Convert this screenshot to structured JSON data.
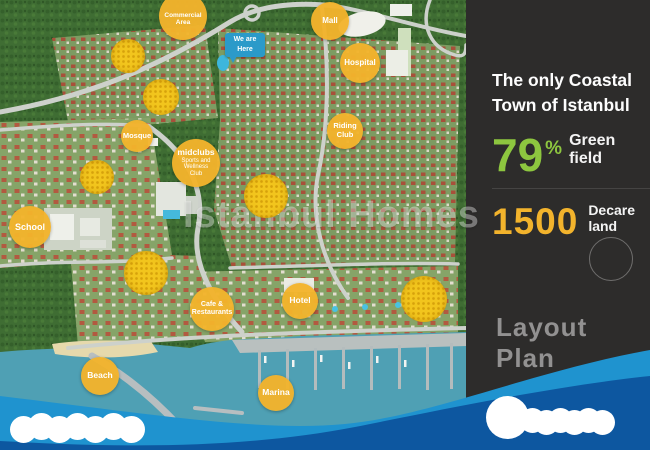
{
  "map": {
    "we_are_here": {
      "line1": "We are",
      "line2": "Here"
    },
    "pois": {
      "commercial_area": "Commercial Area",
      "mall": "Mall",
      "hospital": "Hospital",
      "mosque": "Mosque",
      "riding_club": "Riding Club",
      "midclubs_title": "midclubs",
      "midclubs_subtitle": "Sports and Wellness Club",
      "school": "School",
      "cafe_restaurants": "Cafe & Restaurants",
      "hotel": "Hotel",
      "beach": "Beach",
      "marina": "Marina"
    },
    "watermark": "Istanbul Homes"
  },
  "panel": {
    "heading_line1": "The only Coastal",
    "heading_line2": "Town of Istanbul",
    "green_stat": {
      "value": "79",
      "unit": "%",
      "label": "Green field",
      "color": "#8dc63f"
    },
    "land_stat": {
      "value": "1500",
      "label": "Decare land",
      "color": "#f2b32c"
    },
    "footer_label": "Layout Plan"
  },
  "colors": {
    "poi_yellow": "#f2b32c",
    "scribble_yellow": "#f2c51d",
    "marker_blue": "#2b9ac9",
    "band_light_blue": "#1f93cf",
    "band_dark_blue": "#0d57a0",
    "panel_bg": "#2d2c2b",
    "water_teal": "#4fa0b4"
  }
}
